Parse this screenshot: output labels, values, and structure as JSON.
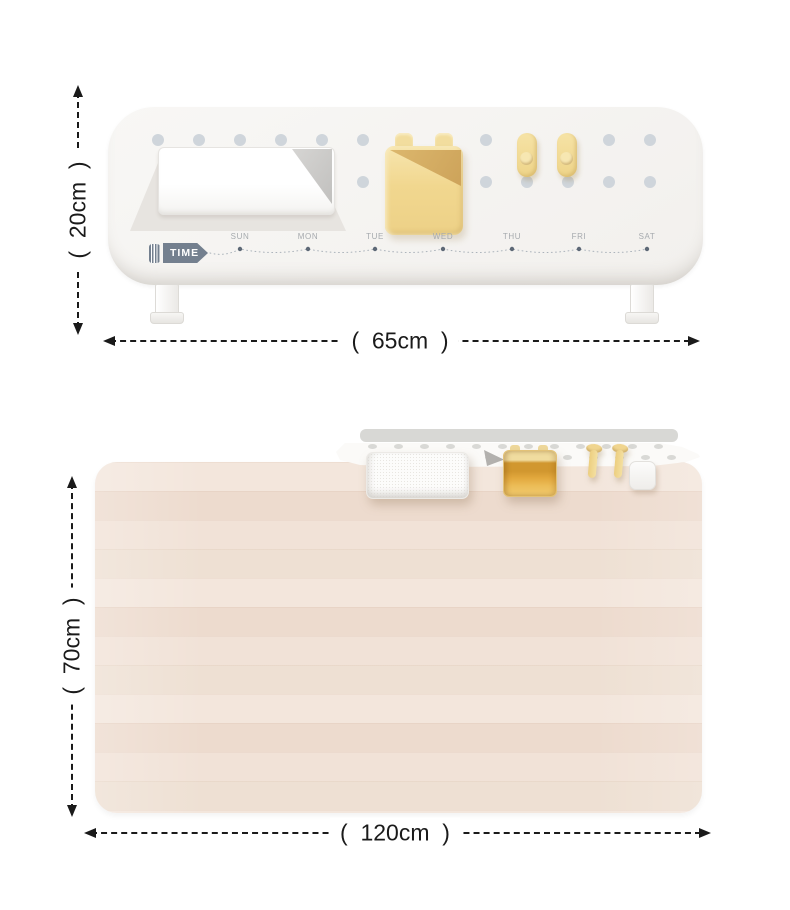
{
  "front_view": {
    "height_label": "(  20cm  )",
    "width_label": "(  65cm  )",
    "time_badge": "TIME",
    "days": [
      "SUN",
      "MON",
      "TUE",
      "WED",
      "THU",
      "FRI",
      "SAT"
    ]
  },
  "top_view": {
    "depth_label": "(  70cm  )",
    "width_label": "(  120cm  )"
  },
  "colors": {
    "dimension_line": "#1a1a1a",
    "badge_slate": "#74808f",
    "pegboard_hole": "#cfd5db",
    "accessory_yellow": "#f0d58d",
    "desk_wood": "#f0e1d6"
  }
}
